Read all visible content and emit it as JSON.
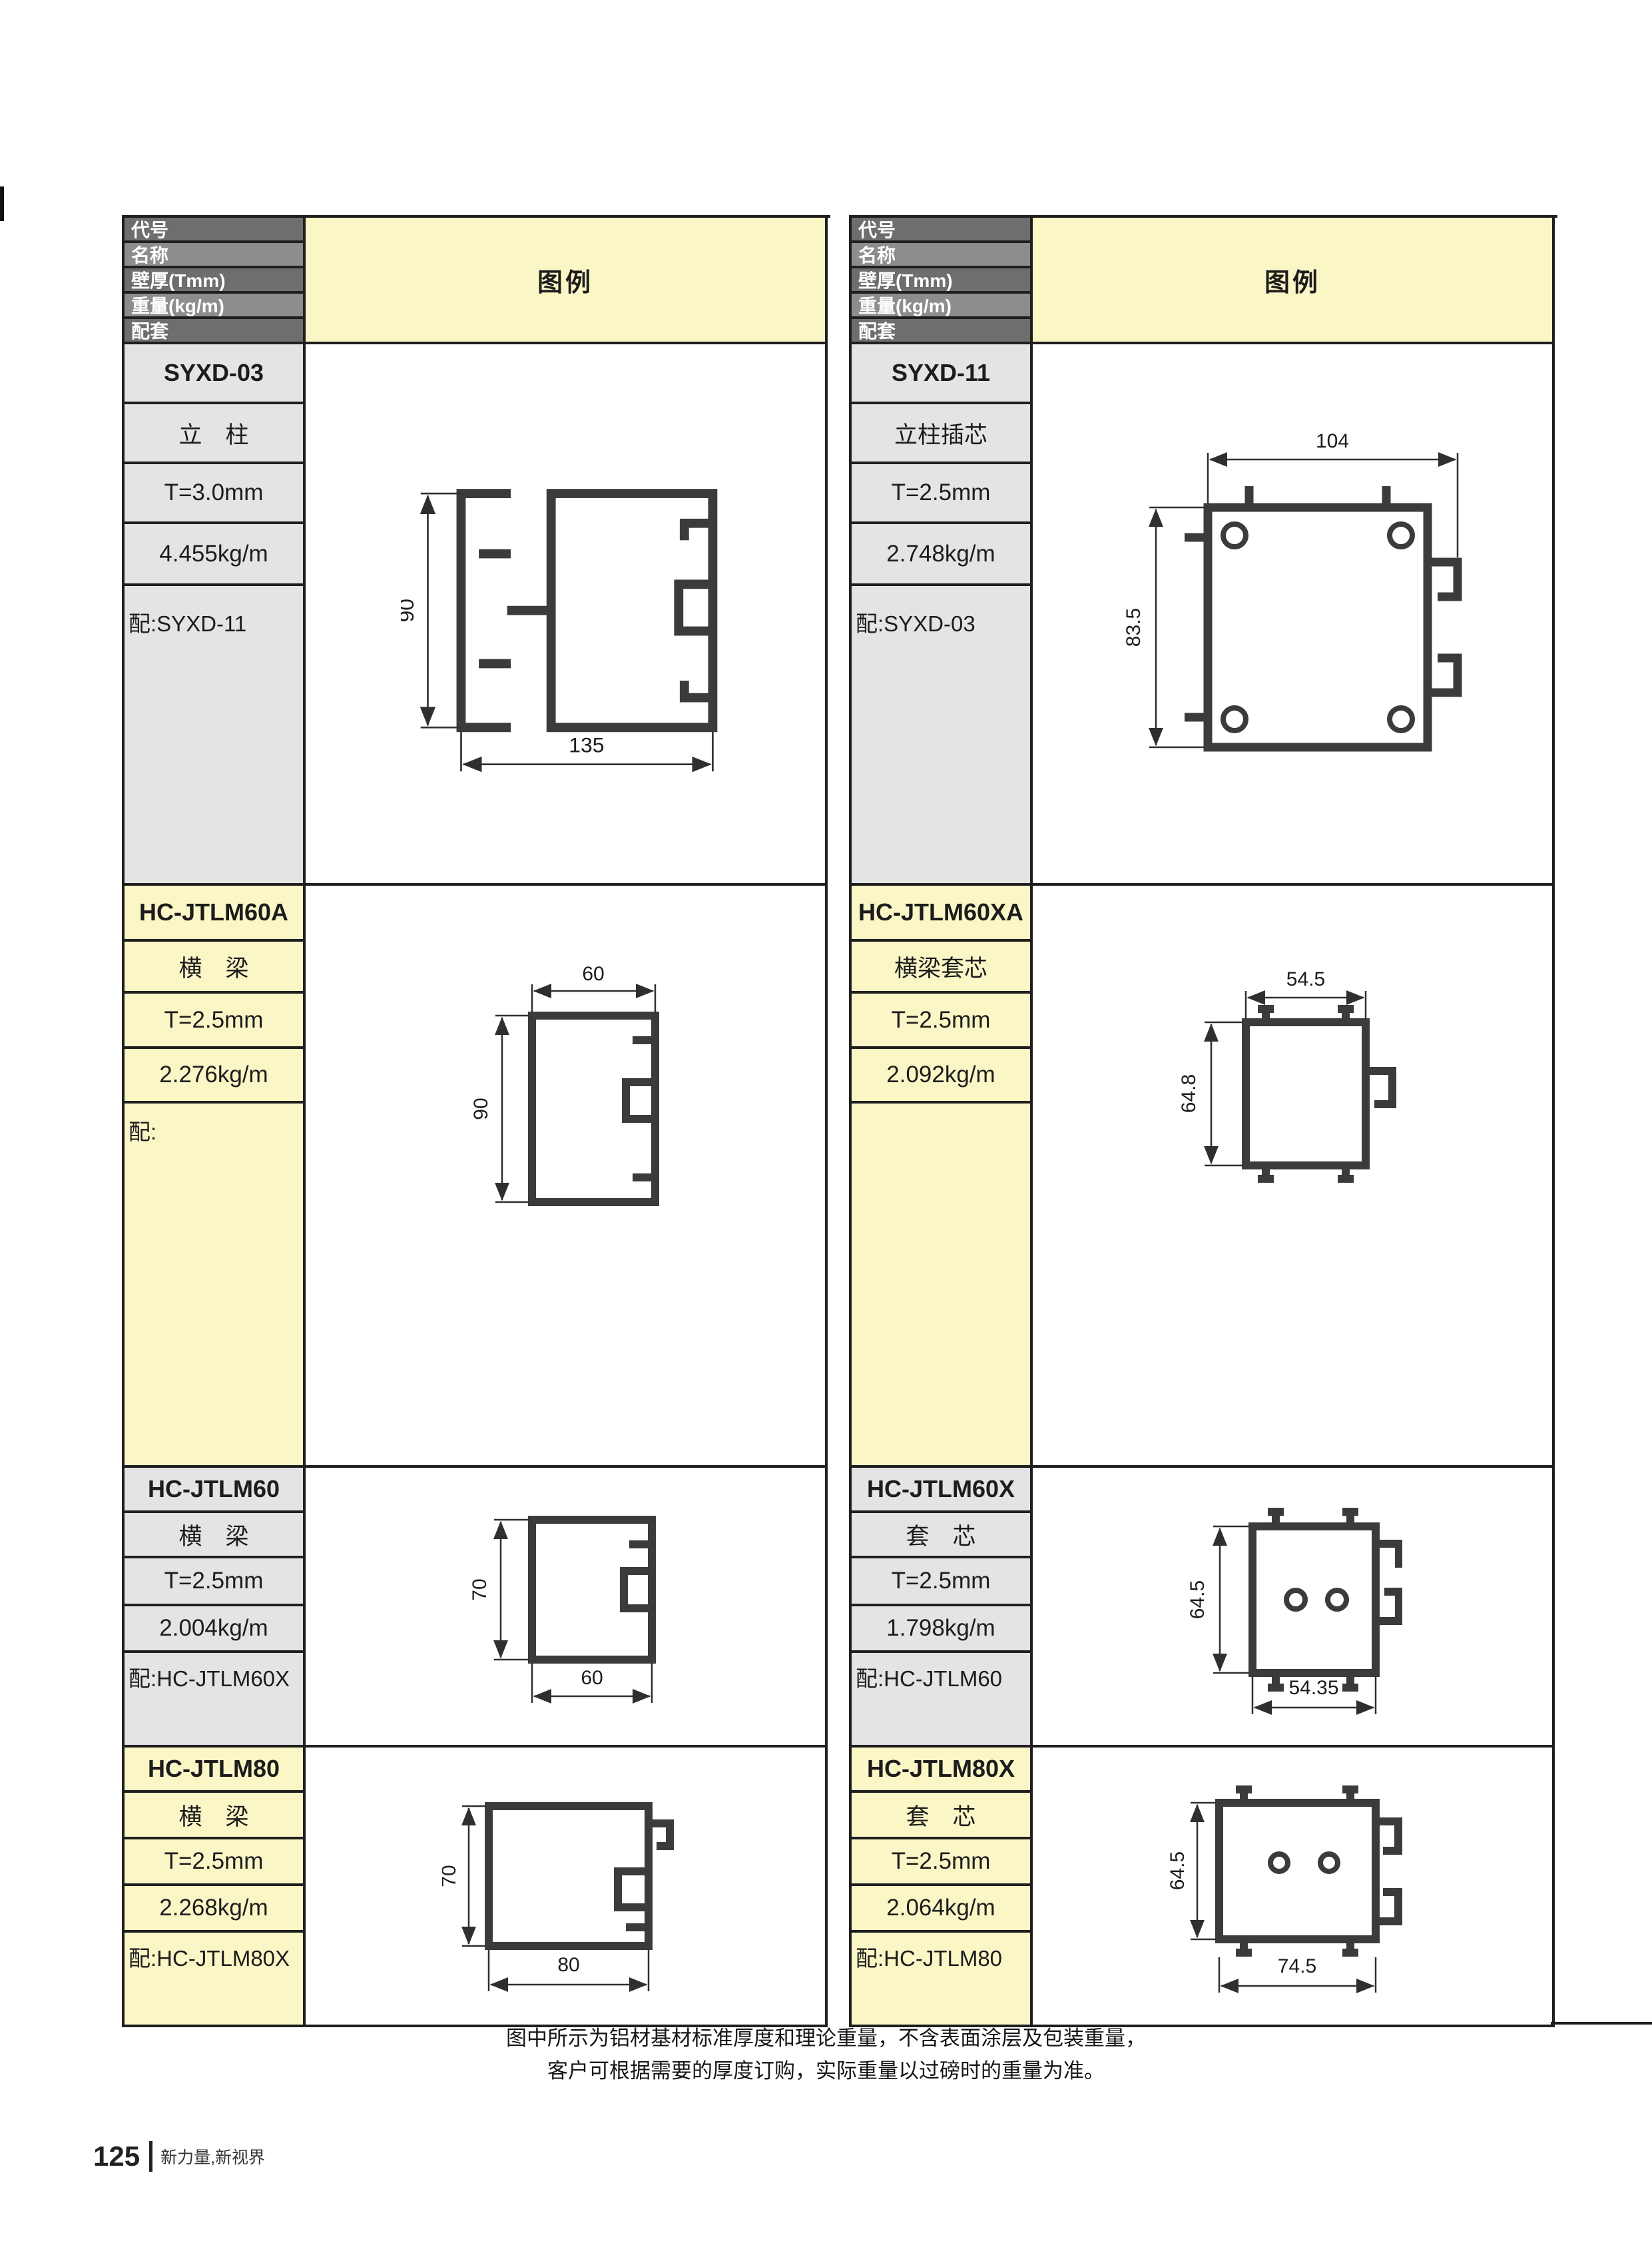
{
  "header": {
    "row_labels": [
      "代号",
      "名称",
      "壁厚(Tmm)",
      "重量(kg/m)",
      "配套"
    ],
    "legend_label": "图例"
  },
  "tables": [
    {
      "side": "left",
      "sections": [
        {
          "code": "SYXD-03",
          "name": "立　柱",
          "thickness": "T=3.0mm",
          "weight": "4.455kg/m",
          "mate": "配:SYXD-11",
          "dim_w": "135",
          "dim_h": "90"
        },
        {
          "code": "HC-JTLM60A",
          "name": "横　梁",
          "thickness": "T=2.5mm",
          "weight": "2.276kg/m",
          "mate": "配:",
          "dim_w": "60",
          "dim_h": "90"
        },
        {
          "code": "HC-JTLM60",
          "name": "横　梁",
          "thickness": "T=2.5mm",
          "weight": "2.004kg/m",
          "mate": "配:HC-JTLM60X",
          "dim_w": "60",
          "dim_h": "70"
        },
        {
          "code": "HC-JTLM80",
          "name": "横　梁",
          "thickness": "T=2.5mm",
          "weight": "2.268kg/m",
          "mate": "配:HC-JTLM80X",
          "dim_w": "80",
          "dim_h": "70"
        }
      ]
    },
    {
      "side": "right",
      "sections": [
        {
          "code": "SYXD-11",
          "name": "立柱插芯",
          "thickness": "T=2.5mm",
          "weight": "2.748kg/m",
          "mate": "配:SYXD-03",
          "dim_w": "104",
          "dim_h": "83.5"
        },
        {
          "code": "HC-JTLM60XA",
          "name": "横梁套芯",
          "thickness": "T=2.5mm",
          "weight": "2.092kg/m",
          "mate": "",
          "dim_w": "54.5",
          "dim_h": "64.8"
        },
        {
          "code": "HC-JTLM60X",
          "name": "套　芯",
          "thickness": "T=2.5mm",
          "weight": "1.798kg/m",
          "mate": "配:HC-JTLM60",
          "dim_w": "54.35",
          "dim_h": "64.5"
        },
        {
          "code": "HC-JTLM80X",
          "name": "套　芯",
          "thickness": "T=2.5mm",
          "weight": "2.064kg/m",
          "mate": "配:HC-JTLM80",
          "dim_w": "74.5",
          "dim_h": "64.5"
        }
      ]
    }
  ],
  "footnote": {
    "line1": "图中所示为铝材基材标准厚度和理论重量，不含表面涂层及包装重量，",
    "line2": "客户可根据需要的厚度订购，实际重量以过磅时的重量为准。"
  },
  "footer": {
    "page_number": "125",
    "slogan": "新力量,新视界"
  },
  "colors": {
    "header_row_dark": "#6e6e6e",
    "header_row_light": "#8d8d8d",
    "legend_yellow": "#FAF6C6",
    "cell_gray": "#E4E4E4",
    "table_line": "#1f1f1f",
    "drawing_stroke": "#3b3b3b"
  }
}
